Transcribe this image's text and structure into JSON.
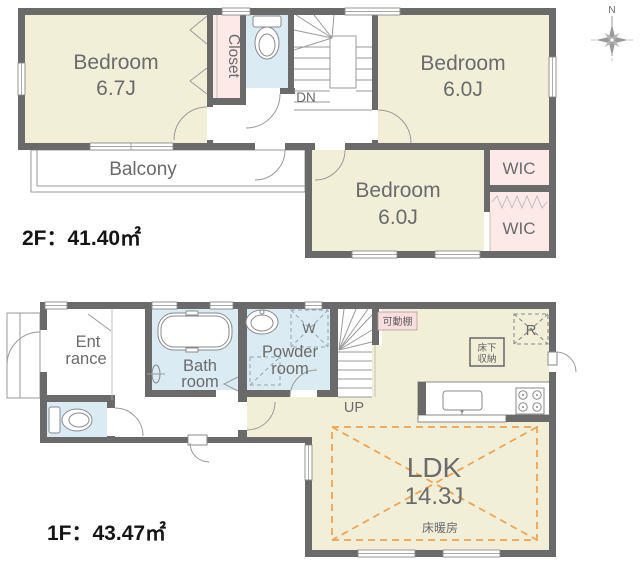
{
  "f2": {
    "area": "2F：41.40㎡",
    "bedroom1": {
      "name": "Bedroom",
      "size": "6.7J"
    },
    "bedroom2": {
      "name": "Bedroom",
      "size": "6.0J"
    },
    "bedroom3": {
      "name": "Bedroom",
      "size": "6.0J"
    },
    "closet": "Closet",
    "wic1": "WIC",
    "wic2": "WIC",
    "balcony": "Balcony",
    "stairs_down": "DN"
  },
  "f1": {
    "area": "1F：43.47㎡",
    "entrance": {
      "l1": "Ent",
      "l2": "rance"
    },
    "bath": {
      "l1": "Bath",
      "l2": "room"
    },
    "powder": {
      "l1": "Powder",
      "l2": "room"
    },
    "washer": "W",
    "stairs_up": "UP",
    "shelf": "可動棚",
    "floor_storage": {
      "l1": "床下",
      "l2": "収納"
    },
    "fridge": "R",
    "ldk": {
      "name": "LDK",
      "size": "14.3J",
      "heating": "床暖房"
    }
  },
  "compass": {
    "north": "N"
  },
  "colors": {
    "wall": "#6a6a6a",
    "room_beige": "#f2efd9",
    "wet_blue": "#daebf3",
    "closet_pink": "#fce9e8",
    "heating_orange": "#f0a452"
  }
}
